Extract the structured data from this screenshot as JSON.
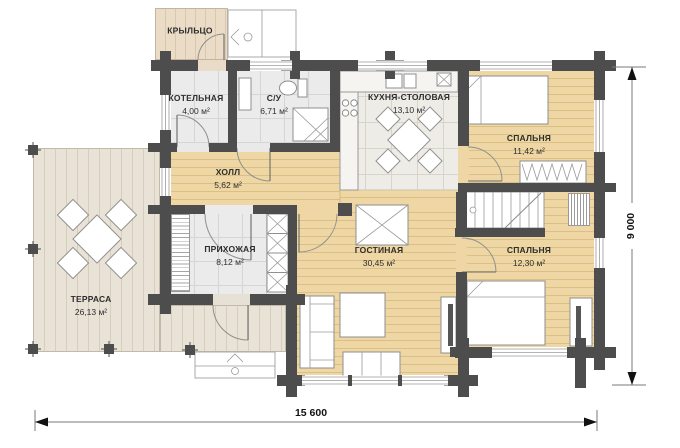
{
  "plan": {
    "title": "Floor plan of one-storey timber house",
    "rooms": [
      {
        "id": "porch",
        "name": "КРЫЛЬЦО",
        "area": ""
      },
      {
        "id": "boiler",
        "name": "КОТЕЛЬНАЯ",
        "area": "4,00 м²"
      },
      {
        "id": "bathroom",
        "name": "С/У",
        "area": "6,71 м²"
      },
      {
        "id": "kitchen",
        "name": "КУХНЯ-СТОЛОВАЯ",
        "area": "13,10 м²"
      },
      {
        "id": "bedroom1",
        "name": "СПАЛЬНЯ",
        "area": "11,42 м²"
      },
      {
        "id": "hall",
        "name": "ХОЛЛ",
        "area": "5,62 м²"
      },
      {
        "id": "hallway",
        "name": "ПРИХОЖАЯ",
        "area": "8,12 м²"
      },
      {
        "id": "living",
        "name": "ГОСТИНАЯ",
        "area": "30,45 м²"
      },
      {
        "id": "bedroom2",
        "name": "СПАЛЬНЯ",
        "area": "12,30 м²"
      },
      {
        "id": "terrace",
        "name": "ТЕРРАСА",
        "area": "26,13 м²"
      }
    ],
    "dimensions": {
      "width": "15 600",
      "height": "9 000"
    },
    "colors": {
      "wall": "#4d4d4d",
      "room_wood": "#eed7a4",
      "deck_wood": "#e9e2d6",
      "tile": "#ebebeb",
      "dimension": "#111111"
    }
  }
}
